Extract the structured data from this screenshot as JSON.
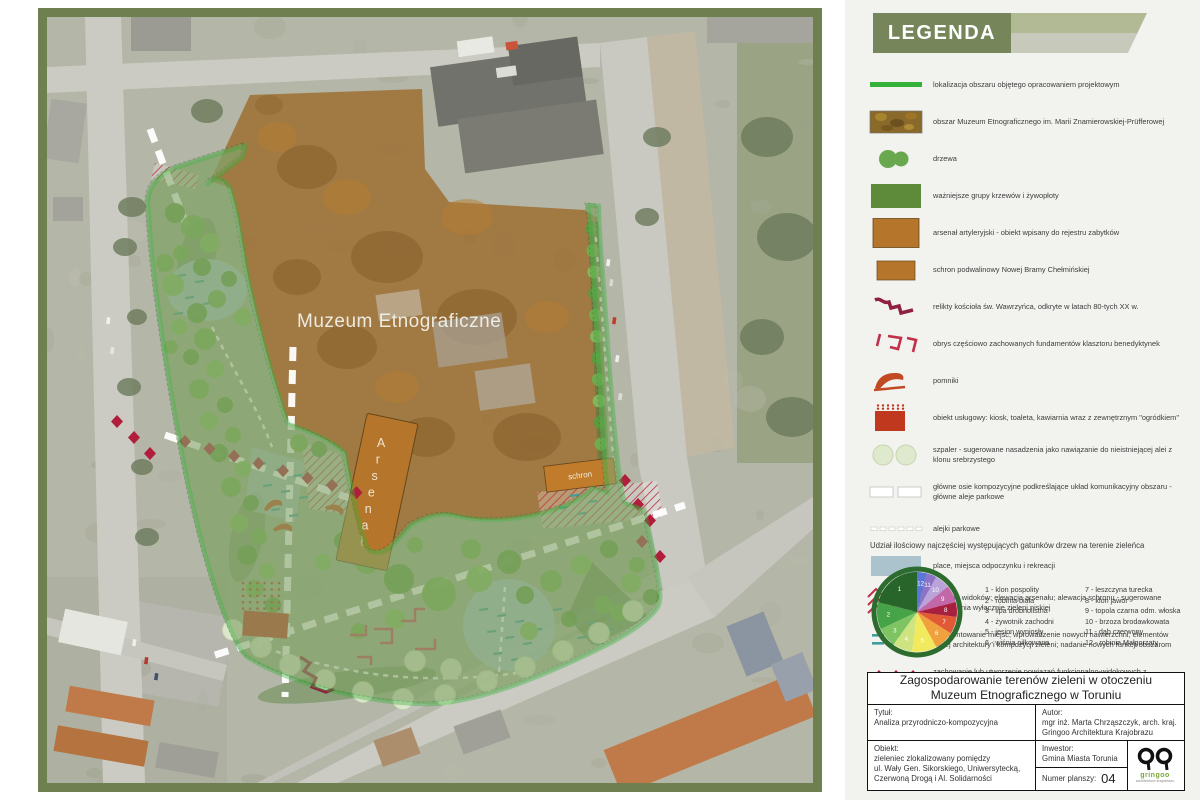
{
  "palette": {
    "frame_olive": "#6f7f50",
    "panel_bg": "#f2f2ef",
    "header_green": "#77865a",
    "header_light": "#b2ba95",
    "header_gray": "#c7c9ba",
    "boundary_green": "#35b13a",
    "museum_brown": "#9c6b2d",
    "arsenal_brown": "#b5762b",
    "monument_red": "#c24a22",
    "service_red": "#c0391f",
    "diamond_red": "#b01e3c",
    "relic_darkred": "#8e2040",
    "foundation_red": "#c9485f",
    "hatch_red": "#c03048",
    "teal": "#3f9e9a",
    "plaza_blue": "#aac3cc",
    "tree_green": "#6aa84f",
    "shrub_green": "#5d8b3a",
    "szpaler_green": "#dfe9cd",
    "text_dark": "#3a3a3a",
    "logo_green": "#76a832"
  },
  "map": {
    "labels": {
      "museum": "Muzeum Etnograficzne",
      "arsenal": "Arsenał",
      "schron": "schron"
    }
  },
  "legend": {
    "title": "LEGENDA",
    "items": [
      {
        "swatch": "line",
        "label": "lokalizacja obszaru objętego opracowaniem projektowym"
      },
      {
        "swatch": "photo",
        "label": "obszar Muzeum Etnograficznego im. Marii Znamierowskiej-Prüfferowej"
      },
      {
        "swatch": "trees",
        "label": "drzewa"
      },
      {
        "swatch": "shrubs",
        "label": "ważniejsze grupy krzewów i żywopłoty"
      },
      {
        "swatch": "arsenal",
        "label": "arsenał artyleryjski - obiekt wpisany do rejestru zabytków"
      },
      {
        "swatch": "schron",
        "label": "schron podwalinowy Nowej Bramy Chełmińskiej"
      },
      {
        "swatch": "relics",
        "label": "relikty kościoła św. Wawrzyńca, odkryte w latach 80-tych XX w."
      },
      {
        "swatch": "foundations",
        "label": "obrys częściowo zachowanych fundamentów klasztoru benedyktynek"
      },
      {
        "swatch": "monument",
        "label": "pomniki"
      },
      {
        "swatch": "service",
        "label": "obiekt usługowy: kiosk, toaleta, kawiarnia wraz z zewnętrznym \"ogródkiem\""
      },
      {
        "swatch": "szpaler",
        "label": "szpaler - sugerowane nasadzenia jako nawiązanie do nieistniejącej alei z klonu srebrzystego"
      },
      {
        "swatch": "axes",
        "label": "główne osie kompozycyjne podkreślające układ komunikacyjny obszaru - główne aleje parkowe"
      },
      {
        "swatch": "paths",
        "label": "alejki parkowe"
      },
      {
        "swatch": "plaza",
        "label": "place, miejsca odpoczynku i rekreacji"
      },
      {
        "swatch": "view-hatch",
        "label": "ochrona widoków: elewacja arsenału; alewacja schronu - sugerowane nasadzenia wyłącznie zieleni niskiej"
      },
      {
        "swatch": "accent-dash",
        "label": "zaakcentowanie miejsc; wprowadzenie nowych nawierzchni, elementów małej architektury i kompozycji zieleni; nadanie nowych funkcji obszarom"
      },
      {
        "swatch": "diamonds",
        "label": "zachowanie lub utworzenie powiązań funkcjonalno-widokowych z sąsiadującymi terenami zieleni"
      }
    ]
  },
  "chart_data": {
    "type": "pie",
    "title": "Udział ilościowy najczęściej występujących gatunków drzew na terenie zieleńca",
    "categories": [
      "klon pospolity",
      "robinia biała",
      "lipa drobnolistna",
      "żywotnik zachodni",
      "jesion wyniosły",
      "wiśnia piłkowana",
      "leszczyna turecka",
      "klon jawor",
      "topola czarna odm. włoska",
      "brzoza brodawkowata",
      "dąb czerwony",
      "robinia Małgorzaty"
    ],
    "values": [
      21,
      11,
      8,
      8,
      10,
      8,
      7,
      6,
      7,
      6,
      4,
      4
    ],
    "colors": [
      "#27652a",
      "#47a347",
      "#7fc463",
      "#cde481",
      "#f2ea5e",
      "#f0a03c",
      "#e05a35",
      "#a8203f",
      "#c268a8",
      "#b9a3d8",
      "#8d72c5",
      "#5b77d6"
    ],
    "ring_color": "#2d6b2f",
    "legend_position": "right",
    "label_style": "numbers-on-slices"
  },
  "title_block": {
    "header_line1": "Zagospodarowanie terenów zieleni w otoczeniu",
    "header_line2": "Muzeum Etnograficznego w Toruniu",
    "tytul_label": "Tytuł:",
    "tytul": "Analiza przyrodniczo-kompozycyjna",
    "autor_label": "Autor:",
    "autor_line1": "mgr inż. Marta Chrząszczyk, arch. kraj.",
    "autor_line2": "Gringoo Architektura Krajobrazu",
    "obiekt_label": "Obiekt:",
    "obiekt_line1": "zieleniec zlokalizowany pomiędzy",
    "obiekt_line2": "ul. Wały Gen. Sikorskiego, Uniwersytecką,",
    "obiekt_line3": "Czerwoną Drogą i Al. Solidarności",
    "inwestor_label": "Inwestor:",
    "inwestor": "Gmina Miasta Torunia",
    "numer_label": "Numer planszy:",
    "numer": "04",
    "logo_name": "gringoo",
    "logo_sub": "architektura krajobrazu"
  }
}
